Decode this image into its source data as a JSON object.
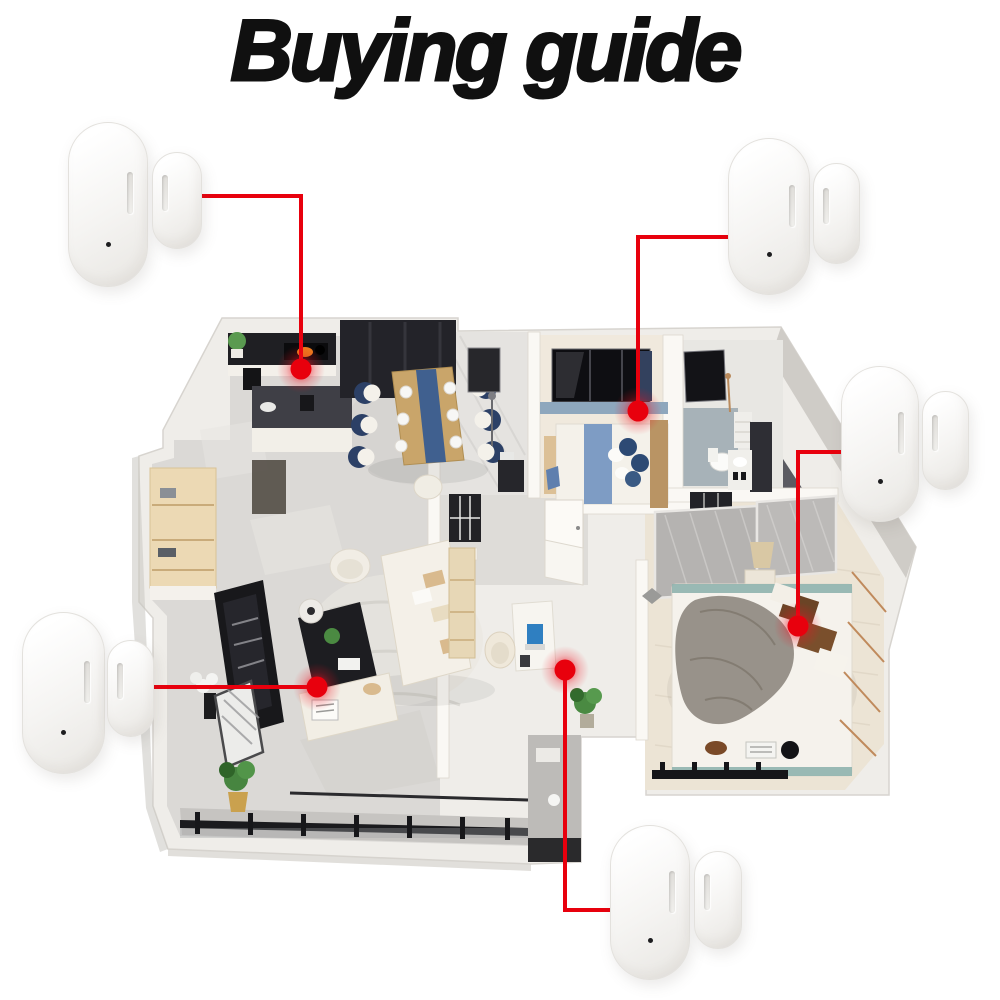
{
  "title": "Buying guide",
  "colors": {
    "background": "#ffffff",
    "title_text": "#101010",
    "accent_red": "#e8000d",
    "glow_red": "#ee1020",
    "sensor_body": "#f5f4f2",
    "sensor_edge": "#e3e1dd"
  },
  "sensors": [
    {
      "name": "door-sensor-top-left",
      "body": {
        "x": 68,
        "y": 122,
        "w": 78,
        "h": 163
      },
      "magnet": {
        "x": 152,
        "y": 152,
        "w": 48,
        "h": 95
      }
    },
    {
      "name": "door-sensor-top-right",
      "body": {
        "x": 728,
        "y": 138,
        "w": 80,
        "h": 155
      },
      "magnet": {
        "x": 813,
        "y": 163,
        "w": 45,
        "h": 99
      }
    },
    {
      "name": "door-sensor-right",
      "body": {
        "x": 841,
        "y": 366,
        "w": 76,
        "h": 154
      },
      "magnet": {
        "x": 922,
        "y": 391,
        "w": 45,
        "h": 97
      }
    },
    {
      "name": "door-sensor-left",
      "body": {
        "x": 22,
        "y": 612,
        "w": 81,
        "h": 160
      },
      "magnet": {
        "x": 107,
        "y": 640,
        "w": 45,
        "h": 95
      }
    },
    {
      "name": "door-sensor-bottom",
      "body": {
        "x": 610,
        "y": 825,
        "w": 78,
        "h": 153
      },
      "magnet": {
        "x": 694,
        "y": 851,
        "w": 46,
        "h": 96
      }
    }
  ],
  "connectors": [
    {
      "name": "kitchen-stove-marker",
      "points": "200,196 301,196 301,369",
      "dot": {
        "x": 301,
        "y": 369
      }
    },
    {
      "name": "bedroom-window-marker",
      "points": "728,237 638,237 638,411",
      "dot": {
        "x": 638,
        "y": 411
      }
    },
    {
      "name": "master-bedroom-marker",
      "points": "841,452 798,452 798,626",
      "dot": {
        "x": 798,
        "y": 626
      }
    },
    {
      "name": "living-room-marker",
      "points": "152,687 317,687",
      "dot": {
        "x": 317,
        "y": 687
      }
    },
    {
      "name": "study-desk-marker",
      "points": "612,910 565,910 565,670",
      "dot": {
        "x": 565,
        "y": 670
      }
    }
  ]
}
